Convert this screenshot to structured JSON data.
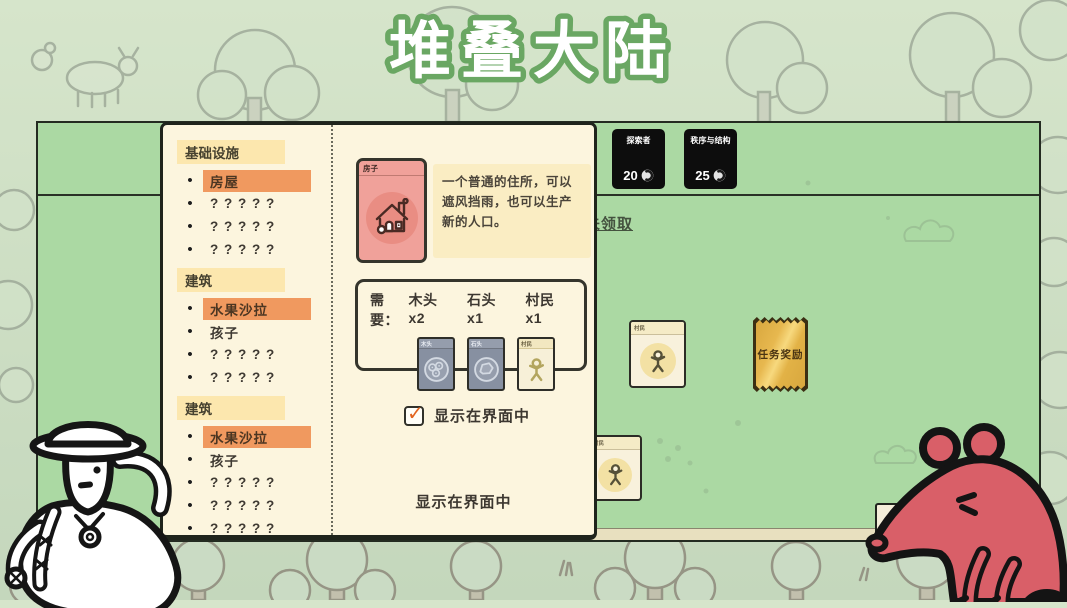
{
  "title": "堆叠大陆",
  "top_cards": [
    {
      "name": "探索者",
      "cost": "20"
    },
    {
      "name": "秩序与结构",
      "cost": "25"
    }
  ],
  "claim_link": "未领取",
  "board": {
    "villager_card_title": "村民",
    "hidden_card_title": "村民",
    "quest_reward_label": "任务奖励"
  },
  "cardopedia": {
    "sections": [
      {
        "header": "基础设施",
        "items": [
          {
            "label": "房屋",
            "highlight": true
          },
          {
            "label": "? ? ? ? ?"
          },
          {
            "label": "? ? ? ? ?"
          },
          {
            "label": "? ? ? ? ?"
          }
        ]
      },
      {
        "header": "建筑",
        "items": [
          {
            "label": "水果沙拉",
            "highlight": true
          },
          {
            "label": "孩子"
          },
          {
            "label": "? ? ? ? ?"
          },
          {
            "label": "? ? ? ? ?"
          }
        ]
      },
      {
        "header": "建筑",
        "items": [
          {
            "label": "水果沙拉",
            "highlight": true
          },
          {
            "label": "孩子"
          },
          {
            "label": "? ? ? ? ?"
          },
          {
            "label": "? ? ? ? ?"
          },
          {
            "label": "? ? ? ? ?"
          },
          {
            "label": "? ? ? ? ?"
          }
        ]
      }
    ],
    "detail": {
      "card_title": "房子",
      "description": "一个普通的住所，可以遮风挡雨，也可以生产新的人口。",
      "requires_prefix": "需要：",
      "requirements": [
        {
          "label": "木头x2",
          "card_title": "木头"
        },
        {
          "label": "石头x1",
          "card_title": "石头"
        },
        {
          "label": "村民x1",
          "card_title": "村民"
        }
      ],
      "checkbox_label": "显示在界面中",
      "checked": true,
      "footer_label": "显示在界面中"
    }
  },
  "colors": {
    "board_green": "#abd9a3",
    "panel_cream": "#fcf5de",
    "highlight_orange": "#f0995f",
    "header_yellow": "#fce7ae",
    "house_pink": "#f0a19a",
    "ticket_gold": "#e7b84f",
    "check_orange": "#e2641f",
    "rat_red": "#d95f68",
    "title_outline_green": "#6aa763"
  }
}
